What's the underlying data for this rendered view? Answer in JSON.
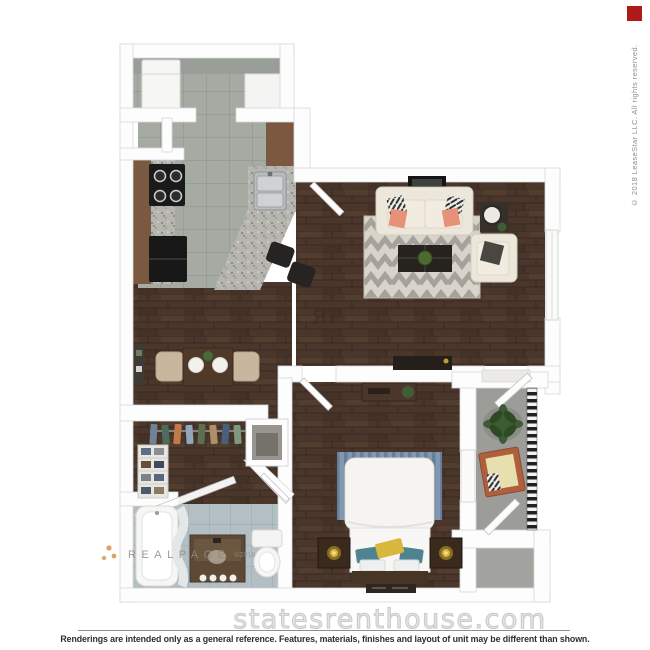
{
  "plan": {
    "rp_monogram": "ЯP"
  },
  "watermarks": {
    "realpage_label": "REALPAGE",
    "realpage_suffix": "©2018",
    "site": "statesrenthouse.com"
  },
  "legal": {
    "copyright_vertical": "© 2018 LeaseStar LLC. All rights reserved."
  },
  "footer": {
    "disclaimer": "Renderings are intended only as a general reference. Features, materials, finishes and layout of unit may be different than shown."
  },
  "colors": {
    "red_indicator": "#ad1a17",
    "wood_floor": "#4a362a",
    "kitchen_tile": "#a5aaa2",
    "bath_tile": "#b4bfc4",
    "patio_concrete": "#9c9c98",
    "rug": "#d8d4cc",
    "coral_pillow": "#e89179",
    "headboard_blue": "#8298b0"
  }
}
